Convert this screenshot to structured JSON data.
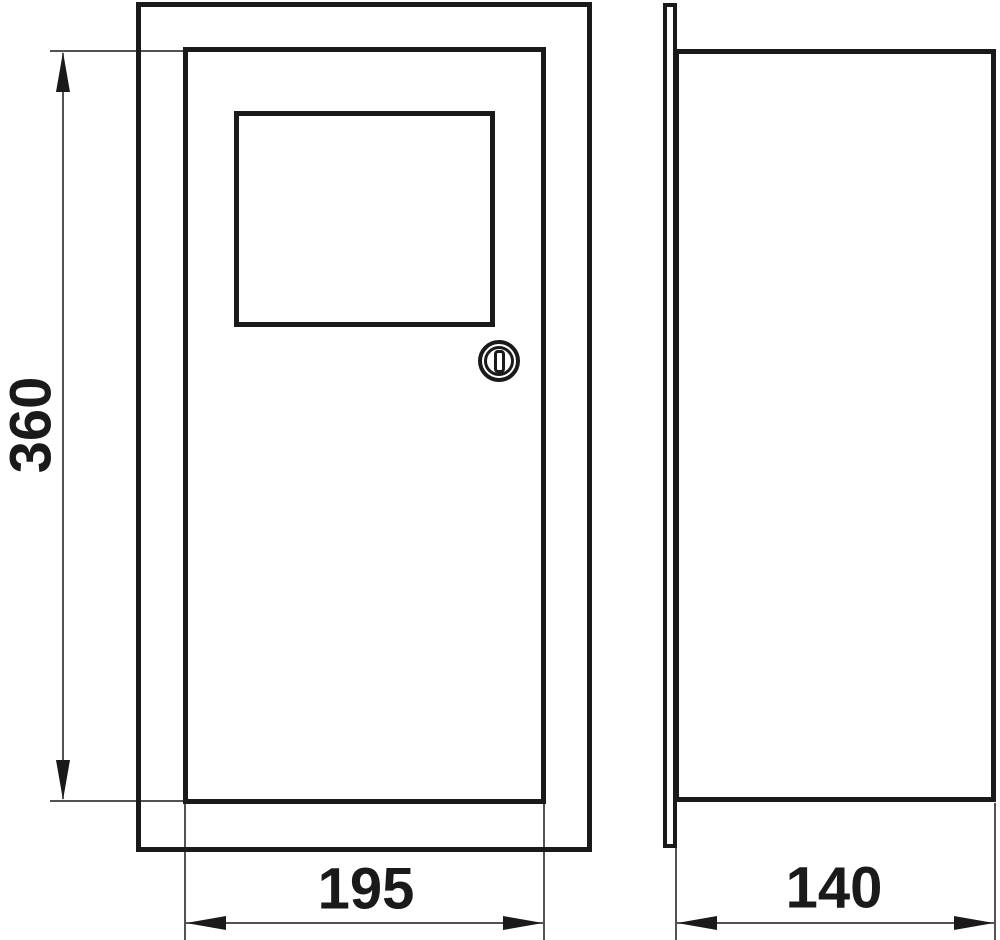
{
  "drawing": {
    "kind": "technical-dimension-drawing",
    "views": {
      "front": "front view with door, inspection window and key lock",
      "side": "side view with mounting flange"
    }
  },
  "dimensions": {
    "height": "360",
    "width": "195",
    "depth": "140"
  },
  "icons": {
    "lock": "door-lock-keyhole"
  },
  "colors": {
    "line": "#1a1a1a",
    "background": "#ffffff"
  }
}
